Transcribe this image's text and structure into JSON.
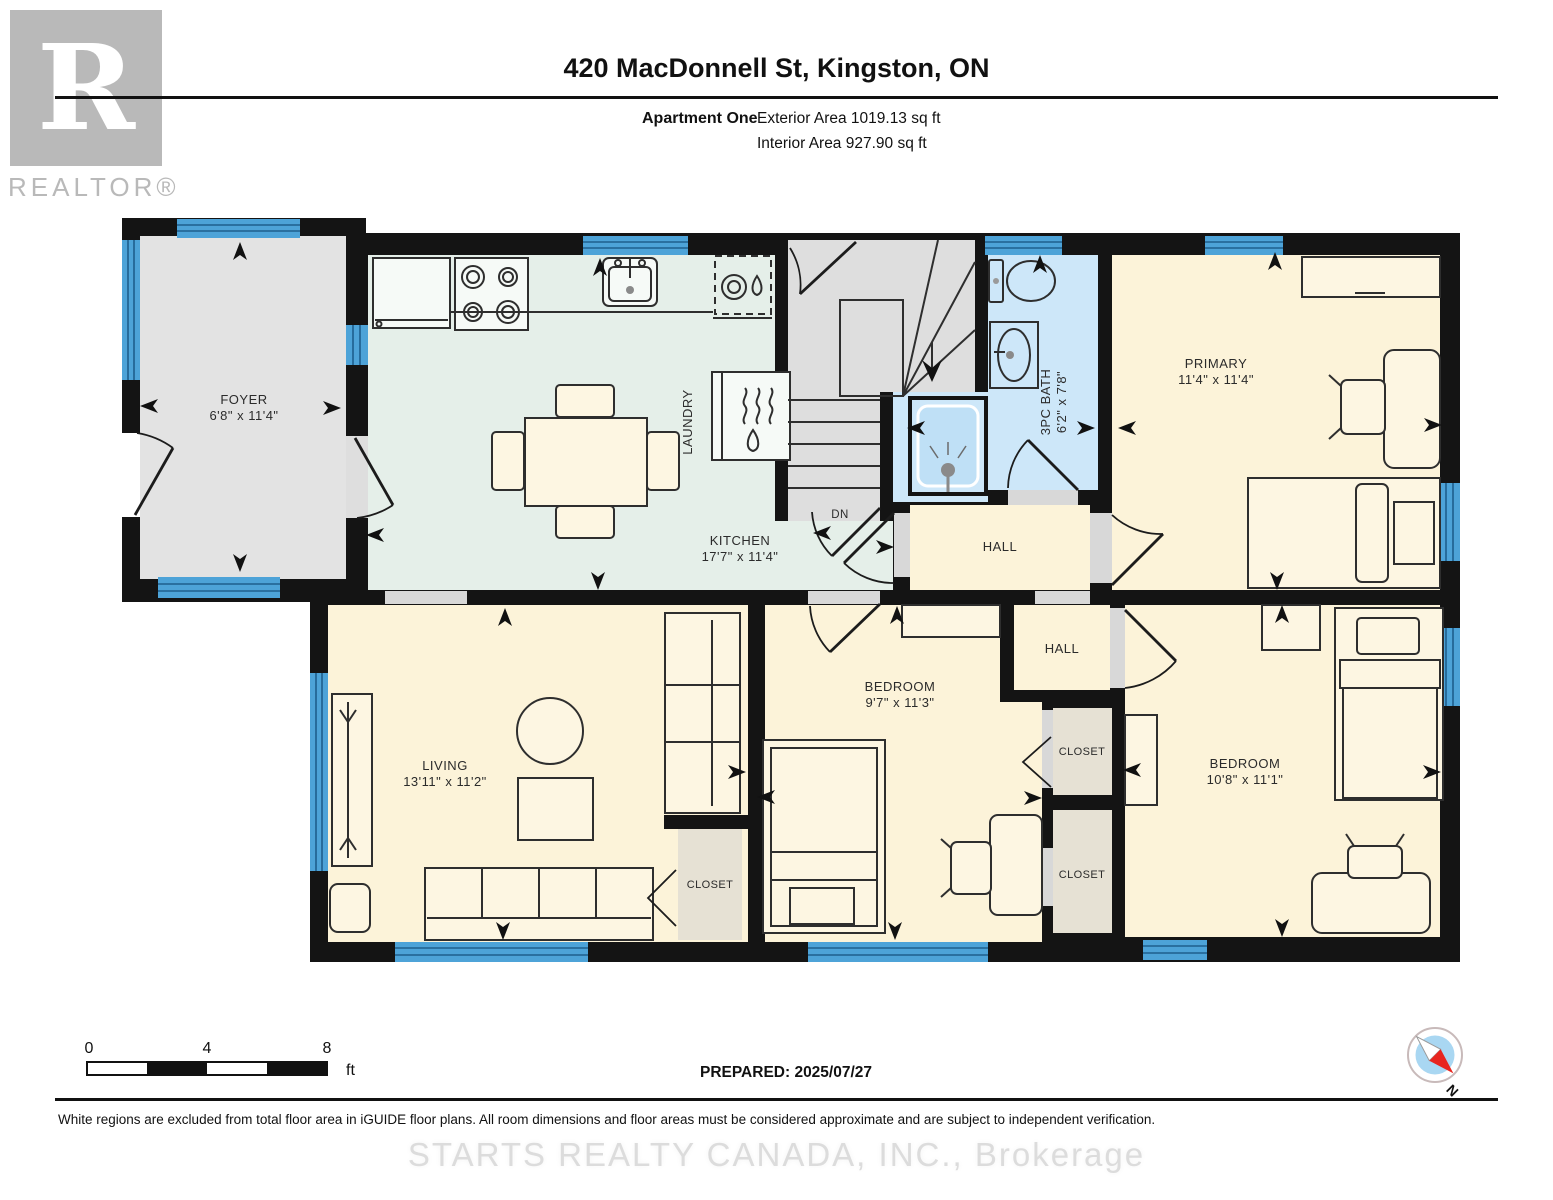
{
  "header": {
    "logo_r": "R",
    "logo_text": "REALTOR®",
    "title": "420 MacDonnell St, Kingston, ON",
    "unit": "Apartment One",
    "exterior": "Exterior Area 1019.13 sq ft",
    "interior": "Interior Area 927.90 sq ft"
  },
  "plan": {
    "foyer": {
      "name": "FOYER",
      "dims": "6'8\" x 11'4\""
    },
    "kitchen": {
      "name": "KITCHEN",
      "dims": "17'7\" x 11'4\""
    },
    "laundry": {
      "name": "LAUNDRY"
    },
    "stairs": {
      "dn": "DN"
    },
    "bath": {
      "name": "3PC BATH",
      "dims": "6'2\" x 7'8\""
    },
    "primary": {
      "name": "PRIMARY",
      "dims": "11'4\" x 11'4\""
    },
    "hall_upper": {
      "name": "HALL"
    },
    "hall_lower": {
      "name": "HALL"
    },
    "living": {
      "name": "LIVING",
      "dims": "13'11\" x 11'2\""
    },
    "bedroom_mid": {
      "name": "BEDROOM",
      "dims": "9'7\" x 11'3\""
    },
    "bedroom_right": {
      "name": "BEDROOM",
      "dims": "10'8\" x 11'1\""
    },
    "closet_living": {
      "name": "CLOSET"
    },
    "closet_upper": {
      "name": "CLOSET"
    },
    "closet_lower": {
      "name": "CLOSET"
    }
  },
  "scalebar": {
    "t0": "0",
    "t4": "4",
    "t8": "8",
    "unit": "ft"
  },
  "prepared": "PREPARED: 2025/07/27",
  "compass": {
    "north": "N"
  },
  "footer": {
    "disclaimer": "White regions are excluded from total floor area in iGUIDE floor plans. All room dimensions and floor areas must be considered approximate and are subject to independent verification.",
    "watermark": "STARTS REALTY CANADA, INC., Brokerage"
  },
  "colors": {
    "wall": "#141414",
    "room_cream": "#fcf3d9",
    "kitchen_mint": "#e5efe9",
    "bath_blue": "#cde7f9",
    "excluded_gray": "#e3e3e3",
    "closet_tan": "#e6e1d4",
    "window_blue": "#4da3d8",
    "compass_red": "#e8251f",
    "compass_blue": "#a9d7f2"
  }
}
